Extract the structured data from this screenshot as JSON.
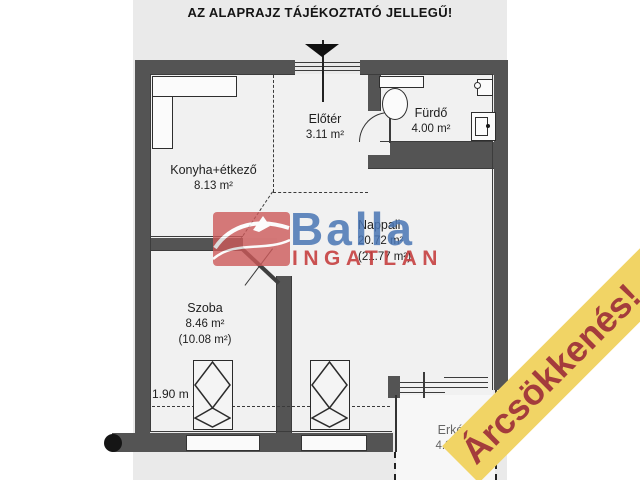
{
  "title": "AZ ALAPRAJZ TÁJÉKOZTATÓ JELLEGŰ!",
  "rooms": {
    "konyha": {
      "name": "Konyha+étkező",
      "area": "8.13 m²"
    },
    "eloter": {
      "name": "Előtér",
      "area": "3.11 m²"
    },
    "furdo": {
      "name": "Fürdő",
      "area": "4.00 m²"
    },
    "nappali": {
      "name": "Nappali",
      "area": "20.72 m²",
      "area_alt": "(21.77 m²)"
    },
    "szoba": {
      "name": "Szoba",
      "area": "8.46 m²",
      "area_alt": "(10.08 m²)"
    },
    "erkely": {
      "name": "Erkély",
      "area": "4.32 m²"
    }
  },
  "dimension": {
    "label": "1.90 m"
  },
  "watermark": {
    "brand": "Balla",
    "subbrand": "INGATLAN"
  },
  "banner": {
    "label": "Árcsökkenés!"
  },
  "colors": {
    "paper": "#eaeaea",
    "wall": "#545454",
    "banner_bg": "#f1d465",
    "banner_text": "#a43c3c",
    "logo_red": "#cd5a5a",
    "brand_blue": "#4a76b4",
    "subbrand_red": "#c64040"
  }
}
